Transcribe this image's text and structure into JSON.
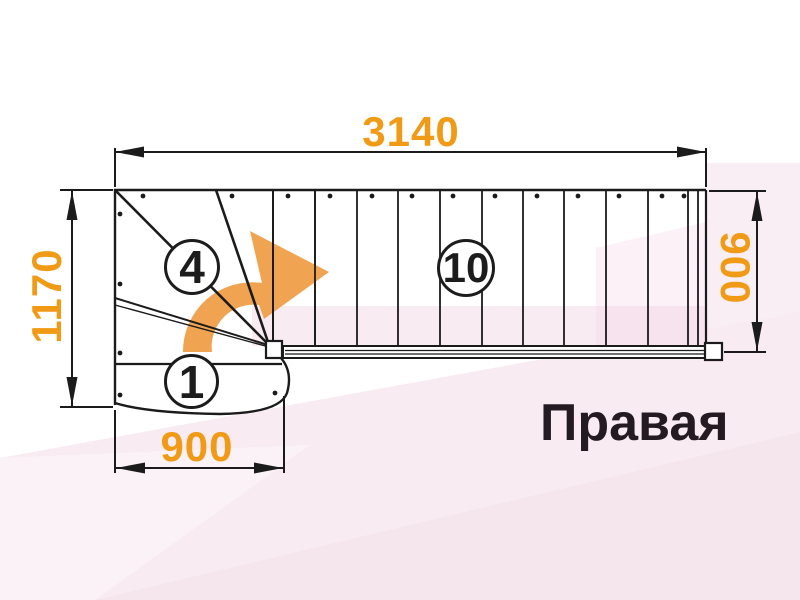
{
  "plan": {
    "orientation_label": "Правая",
    "drawing_name": "stair-plan-right-turn"
  },
  "dimensions": {
    "top": "3140",
    "left": "1170",
    "right": "900",
    "bottom": "900"
  },
  "steps": {
    "first_step": "1",
    "winder_step": "4",
    "straight_step": "10"
  },
  "icons": {
    "direction_arrow": "curved-right-turn-arrow-icon"
  },
  "colors": {
    "dimension_text": "#F09A15",
    "arrow_orange": "#F0A452",
    "line_black": "#1b1b1b",
    "label_text": "#241b22",
    "background_pink": "#f8ecf2",
    "paper_white": "#ffffff"
  }
}
